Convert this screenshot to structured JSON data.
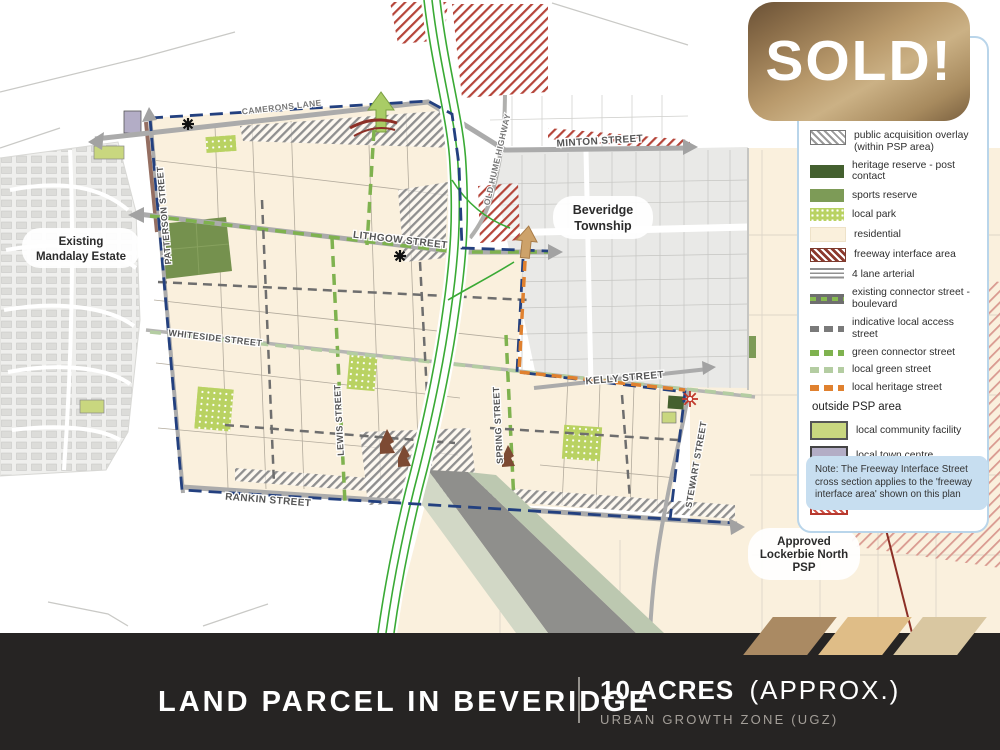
{
  "colors": {
    "gold": "#b4915f",
    "footer_bg": "#262423",
    "residential_cream": "#faf0dc",
    "psp_boundary_navy": "#23407f",
    "heritage_orange": "#e0812f",
    "green_connector": "#7fb24f",
    "note_bg": "#c7def0",
    "freeway_green": "#3aaa35"
  },
  "sold_badge": {
    "label": "SOLD!"
  },
  "legend": {
    "items": [
      {
        "label": "public acquisition overlay (within PSP area)"
      },
      {
        "label": "heritage reserve - post contact"
      },
      {
        "label": "sports reserve"
      },
      {
        "label": "local park"
      },
      {
        "label": "residential"
      },
      {
        "label": "freeway interface area"
      },
      {
        "label": "4 lane arterial"
      },
      {
        "label": "existing connector street - boulevard"
      },
      {
        "label": "indicative local access street"
      },
      {
        "label": "green connector street"
      },
      {
        "label": "local green street"
      },
      {
        "label": "local heritage street"
      }
    ],
    "outside_header": "outside PSP area",
    "outside_items": [
      {
        "label": "local community facility"
      },
      {
        "label": "local town centre"
      },
      {
        "label": "future government school"
      },
      {
        "label": "public acquisition overlay"
      }
    ]
  },
  "note": {
    "text": "Note: The Freeway Interface Street cross section applies to the 'freeway interface area' shown on this plan"
  },
  "map": {
    "places": {
      "mandalay_line1": "Existing",
      "mandalay_line2": "Mandalay Estate",
      "township_line1": "Beveridge",
      "township_line2": "Township",
      "lockerbie_line1": "Approved",
      "lockerbie_line2": "Lockerbie North",
      "lockerbie_line3": "PSP"
    },
    "streets": {
      "camerons": "CAMERONS LANE",
      "minton": "MINTON STREET",
      "lithgow": "LITHGOW STREET",
      "whiteside": "WHITESIDE STREET",
      "kelly": "KELLY STREET",
      "rankin": "RANKIN STREET",
      "patterson": "PATTERSON STREET",
      "lewis": "LEWIS STREET",
      "spring": "SPRING STREET",
      "stewart": "STEWART STREET",
      "old_hume": "OLD HUME HIGHWAY"
    }
  },
  "footer": {
    "title": "LAND PARCEL IN BEVERIDGE",
    "acres_bold": "10 ACRES",
    "acres_light": "(APPROX.)",
    "subtitle": "URBAN GROWTH ZONE (UGZ)"
  }
}
